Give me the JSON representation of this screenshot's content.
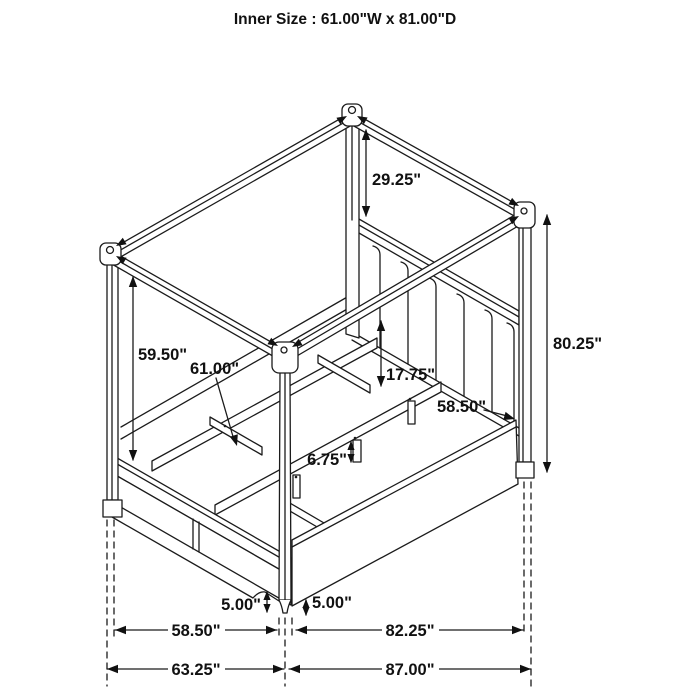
{
  "title": "Inner Size : 61.00\"W x 81.00\"D",
  "diagram": {
    "type": "furniture-dimension-line-drawing",
    "subject": "four-poster canopy storage bed with upholstered channel headboard, slat platform and footboard drawers",
    "inner_size": {
      "width": "61.00\"",
      "depth": "81.00\""
    }
  },
  "labels": {
    "d29_25": "29.25\"",
    "d80_25": "80.25\"",
    "d59_50": "59.50\"",
    "d61_00": "61.00\"",
    "d17_75": "17.75\"",
    "d58_50_diag": "58.50\"",
    "d6_75": "6.75\"",
    "d5_00_left": "5.00\"",
    "d5_00_right": "5.00\"",
    "d58_50_bottom": "58.50\"",
    "d82_25": "82.25\"",
    "d63_25": "63.25\"",
    "d87_00": "87.00\""
  }
}
